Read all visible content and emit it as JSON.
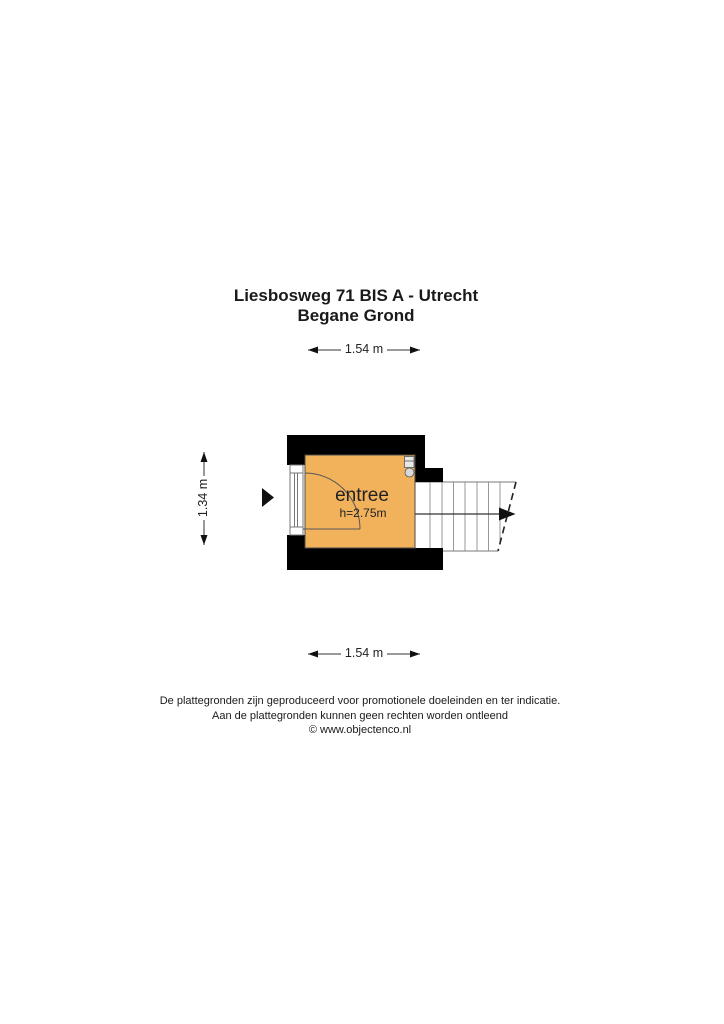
{
  "header": {
    "title_line1": "Liesbosweg 71 BIS A - Utrecht",
    "title_line2": "Begane Grond"
  },
  "plan": {
    "room": {
      "label": "entree",
      "ceiling_height": "h=2.75m",
      "floor_color": "#F2B25C"
    },
    "dimensions": {
      "width_top": "1.54 m",
      "width_bottom": "1.54 m",
      "height_left": "1.34 m"
    },
    "colors": {
      "wall": "#000000",
      "stairs_outline": "#8a8a8a",
      "dimension_line": "#333333"
    }
  },
  "footer": {
    "line1": "De plattegronden zijn geproduceerd voor promotionele doeleinden en ter indicatie.",
    "line2": "Aan de plattegronden kunnen geen rechten worden ontleend",
    "line3": "© www.objectenco.nl"
  }
}
